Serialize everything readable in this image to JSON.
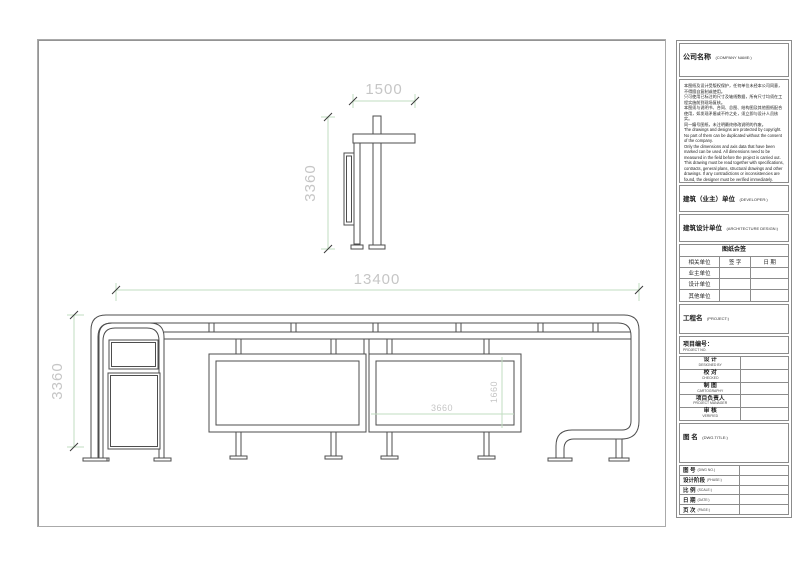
{
  "drawing": {
    "side_view": {
      "width_mm": "1500",
      "height_mm": "3360"
    },
    "elevation": {
      "width_mm": "13400",
      "height_mm": "3360",
      "panel_width_mm": "3660",
      "panel_height_mm": "1660"
    },
    "colors": {
      "structure_line": "#4d4d4d",
      "dim_line": "#c2ddc2",
      "dim_text": "#c6c6c6"
    }
  },
  "title_block": {
    "company": {
      "zh": "公司名称",
      "en": "(COMPANY NAME:)"
    },
    "notes": {
      "zh": "本图纸及设计受版权保护，任何单位未经本公司同意，不得擅自复制或使用。\n只可使用已标注的尺寸及轴线数据，所有尺寸均须在工程实施前到现场复核。\n本图须与说明书、合同、总图、结构图及其他图纸配合使用，如发现矛盾或不符之处，须立即与设计人员核实。\n同一编号图纸，未注明最终修改说明的作废。",
      "en": "The drawings and designs are protected by copyright. No part of them can be duplicated without the consent of the company.\nOnly the dimensions and axis data that have been marked can be used. All dimensions need to be measured in the field before the project is carried out.\nThis drawing must be read together with specifications, contracts, general plans, structural drawings and other drawings. If any contradictions or inconsistencies are found, the designer must be verified immediately.\nThe same numbered drawings which do not show the final modification instructions are discarded and discarded."
    },
    "developer": {
      "zh": "建筑（业主）单位",
      "en": "(DEVELOPER:)"
    },
    "design_unit": {
      "zh": "建筑设计单位",
      "en": "(ARCHITECTURE DESIGN:)"
    },
    "countersign": {
      "title": "图纸会签",
      "header": [
        "相关单位",
        "签 字",
        "日 期"
      ],
      "rows": [
        "业主单位",
        "设计单位",
        "其他单位"
      ]
    },
    "project_name": {
      "zh": "工程名",
      "en": "(PROJECT:)"
    },
    "project_no": {
      "zh": "项目编号：",
      "en": "PROJECT NO."
    },
    "personnel": [
      {
        "zh": "设 计",
        "en": "DESIGNED BY"
      },
      {
        "zh": "校 对",
        "en": "CHECKED"
      },
      {
        "zh": "制 图",
        "en": "CARTOGRAPHY"
      },
      {
        "zh": "项目负责人",
        "en": "PROJECT MANAGER"
      },
      {
        "zh": "审 核",
        "en": "VERIFIED"
      }
    ],
    "dwg_title": {
      "zh": "图 名",
      "en": "(DWG.TITLE:)"
    },
    "bottom_rows": [
      {
        "zh": "图 号",
        "en": "(DWG NO.)"
      },
      {
        "zh": "设计阶段",
        "en": "(PHASE:)"
      },
      {
        "zh": "比 例",
        "en": "(SCALE:)"
      },
      {
        "zh": "日 期",
        "en": "(DATE:)"
      },
      {
        "zh": "页 次",
        "en": "(PAGE:)"
      }
    ]
  }
}
